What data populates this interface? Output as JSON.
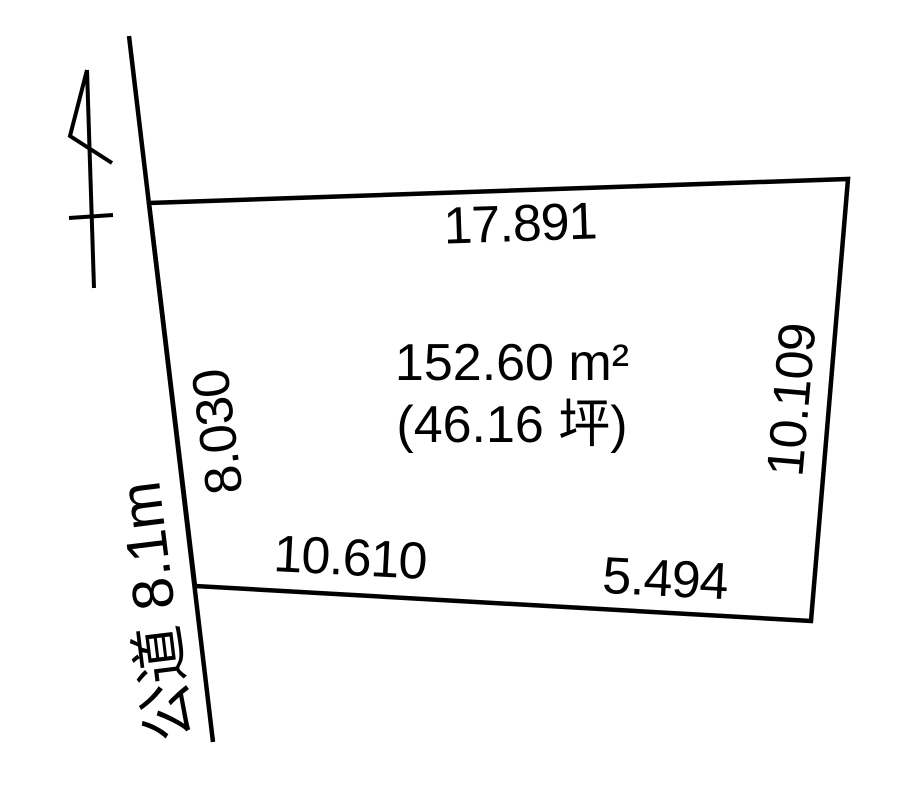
{
  "diagram": {
    "area_label": {
      "square_meters": "152.60 m²",
      "tsubo": "(46.16 坪)"
    },
    "dimensions": {
      "top": "17.891",
      "right": "10.109",
      "left": "8.030",
      "bottom_left": "10.610",
      "bottom_right": "5.494"
    },
    "road_label": "公道 8.1m",
    "icons": {
      "north_arrow": "north-arrow-icon"
    },
    "colors": {
      "line": "#000000",
      "text": "#000000",
      "background": "#ffffff"
    }
  }
}
